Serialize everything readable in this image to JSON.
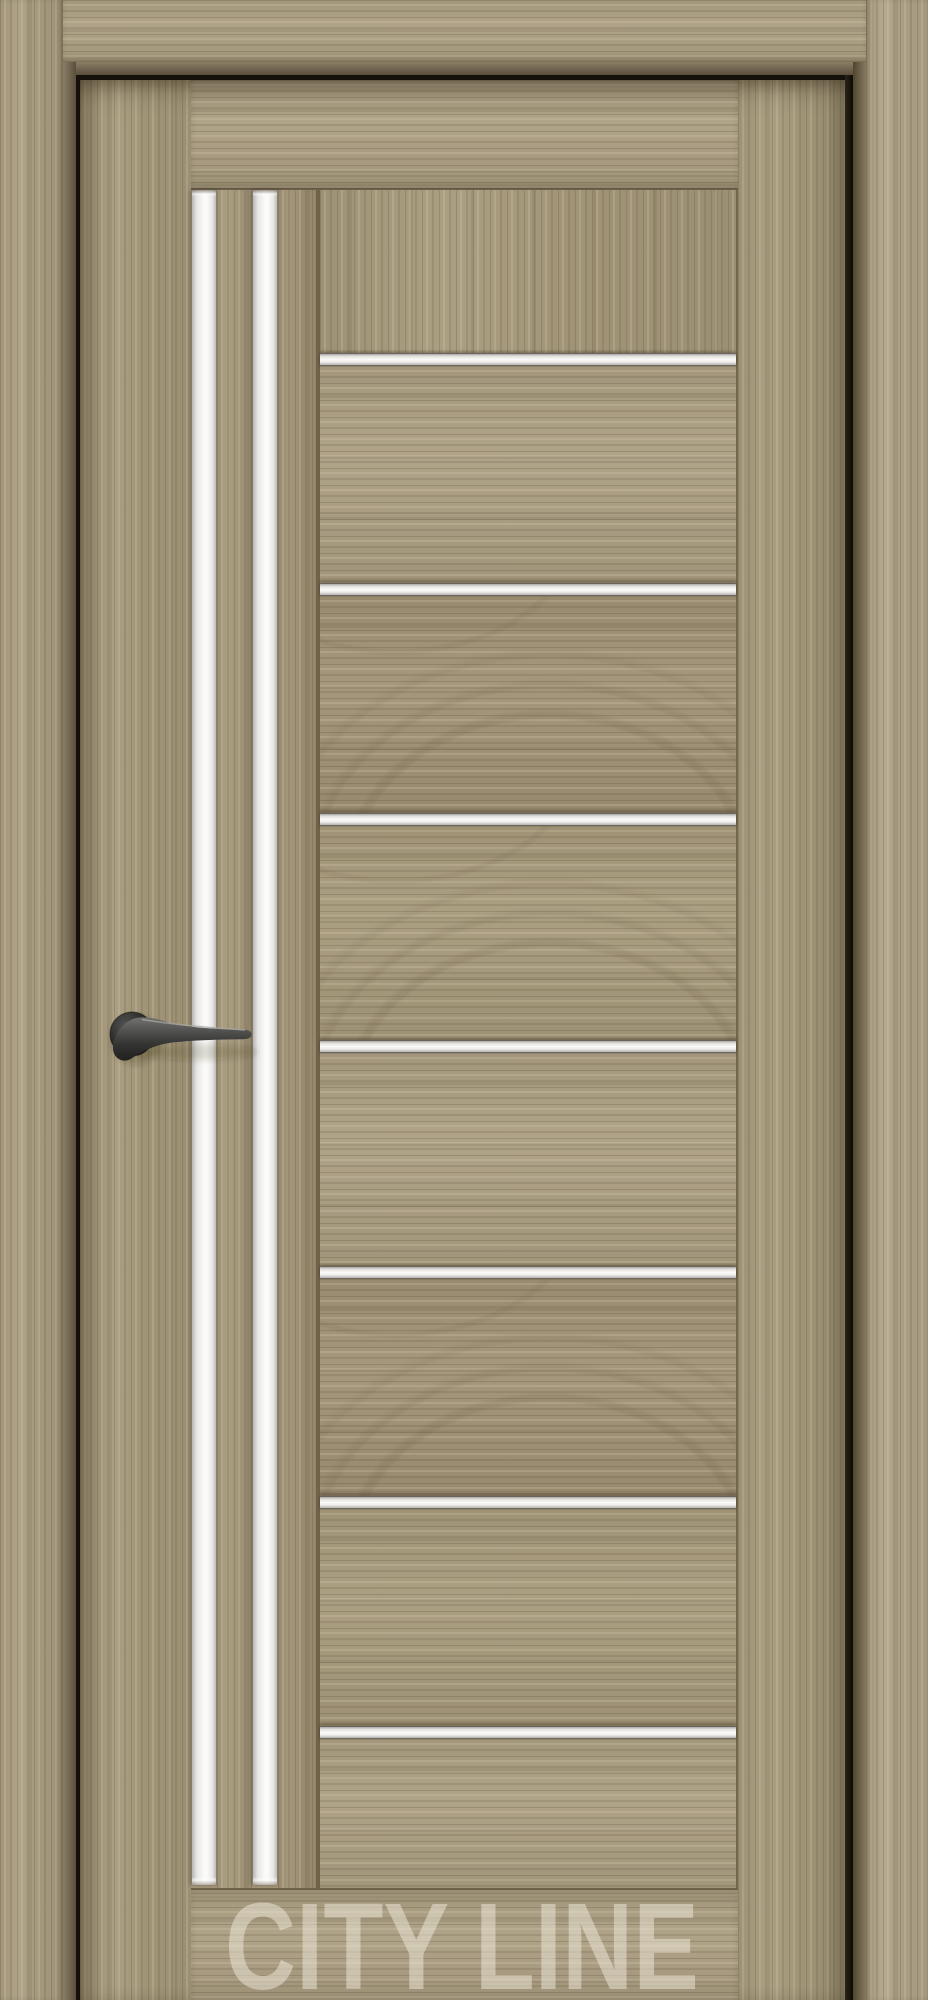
{
  "photo": {
    "subject": "Interior door in light sonoma-oak woodgrain laminate, closed in a matching frame, with two vertical frosted-glass stripes on the hinge side and seven horizontal frosted-glass inserts across the main panel, fitted with a black lever handle",
    "watermark": "CITY LINE"
  },
  "door": {
    "vertical_glass_stripes": 2,
    "horizontal_glass_inserts": 7,
    "handle_side": "left",
    "finish": "light oak woodgrain"
  },
  "colors": {
    "wood_base": "#a89b7e",
    "wood_dark_grain": "#7d6f55",
    "wood_light_streak": "#cfc3a4",
    "casing_right_light": "#b1a489",
    "frame_bevel": "#6f6450",
    "frame_reveal_black": "#15110a",
    "glass_white": "#f9f9f7",
    "handle_black": "#262624",
    "watermark_color": "rgba(241,235,222,0.5)"
  }
}
